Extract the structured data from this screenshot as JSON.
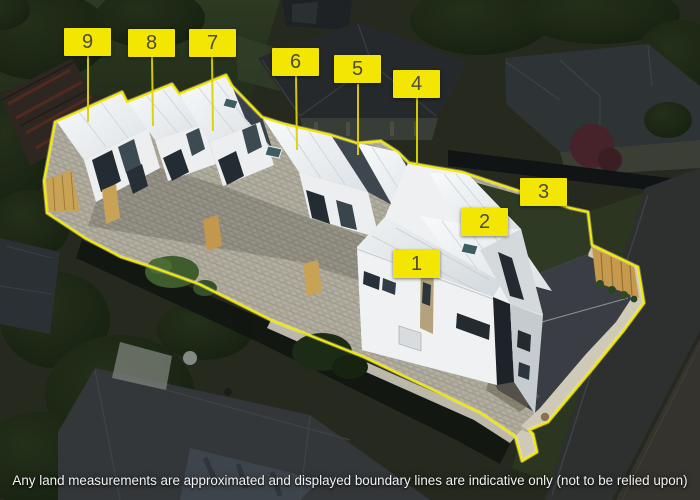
{
  "overlay": {
    "unit_labels": [
      {
        "number": "1"
      },
      {
        "number": "2"
      },
      {
        "number": "3"
      },
      {
        "number": "4"
      },
      {
        "number": "5"
      },
      {
        "number": "6"
      },
      {
        "number": "7"
      },
      {
        "number": "8"
      },
      {
        "number": "9"
      }
    ],
    "disclaimer": "Any land measurements are approximated and displayed boundary lines are indicative only (not to be relied upon)",
    "colors": {
      "label_background": "#f3e602",
      "label_text": "#4b4b3e",
      "boundary_line": "#f2e70a",
      "leader_line": "#ded301",
      "disclaimer_text": "#f2f2f2"
    }
  }
}
